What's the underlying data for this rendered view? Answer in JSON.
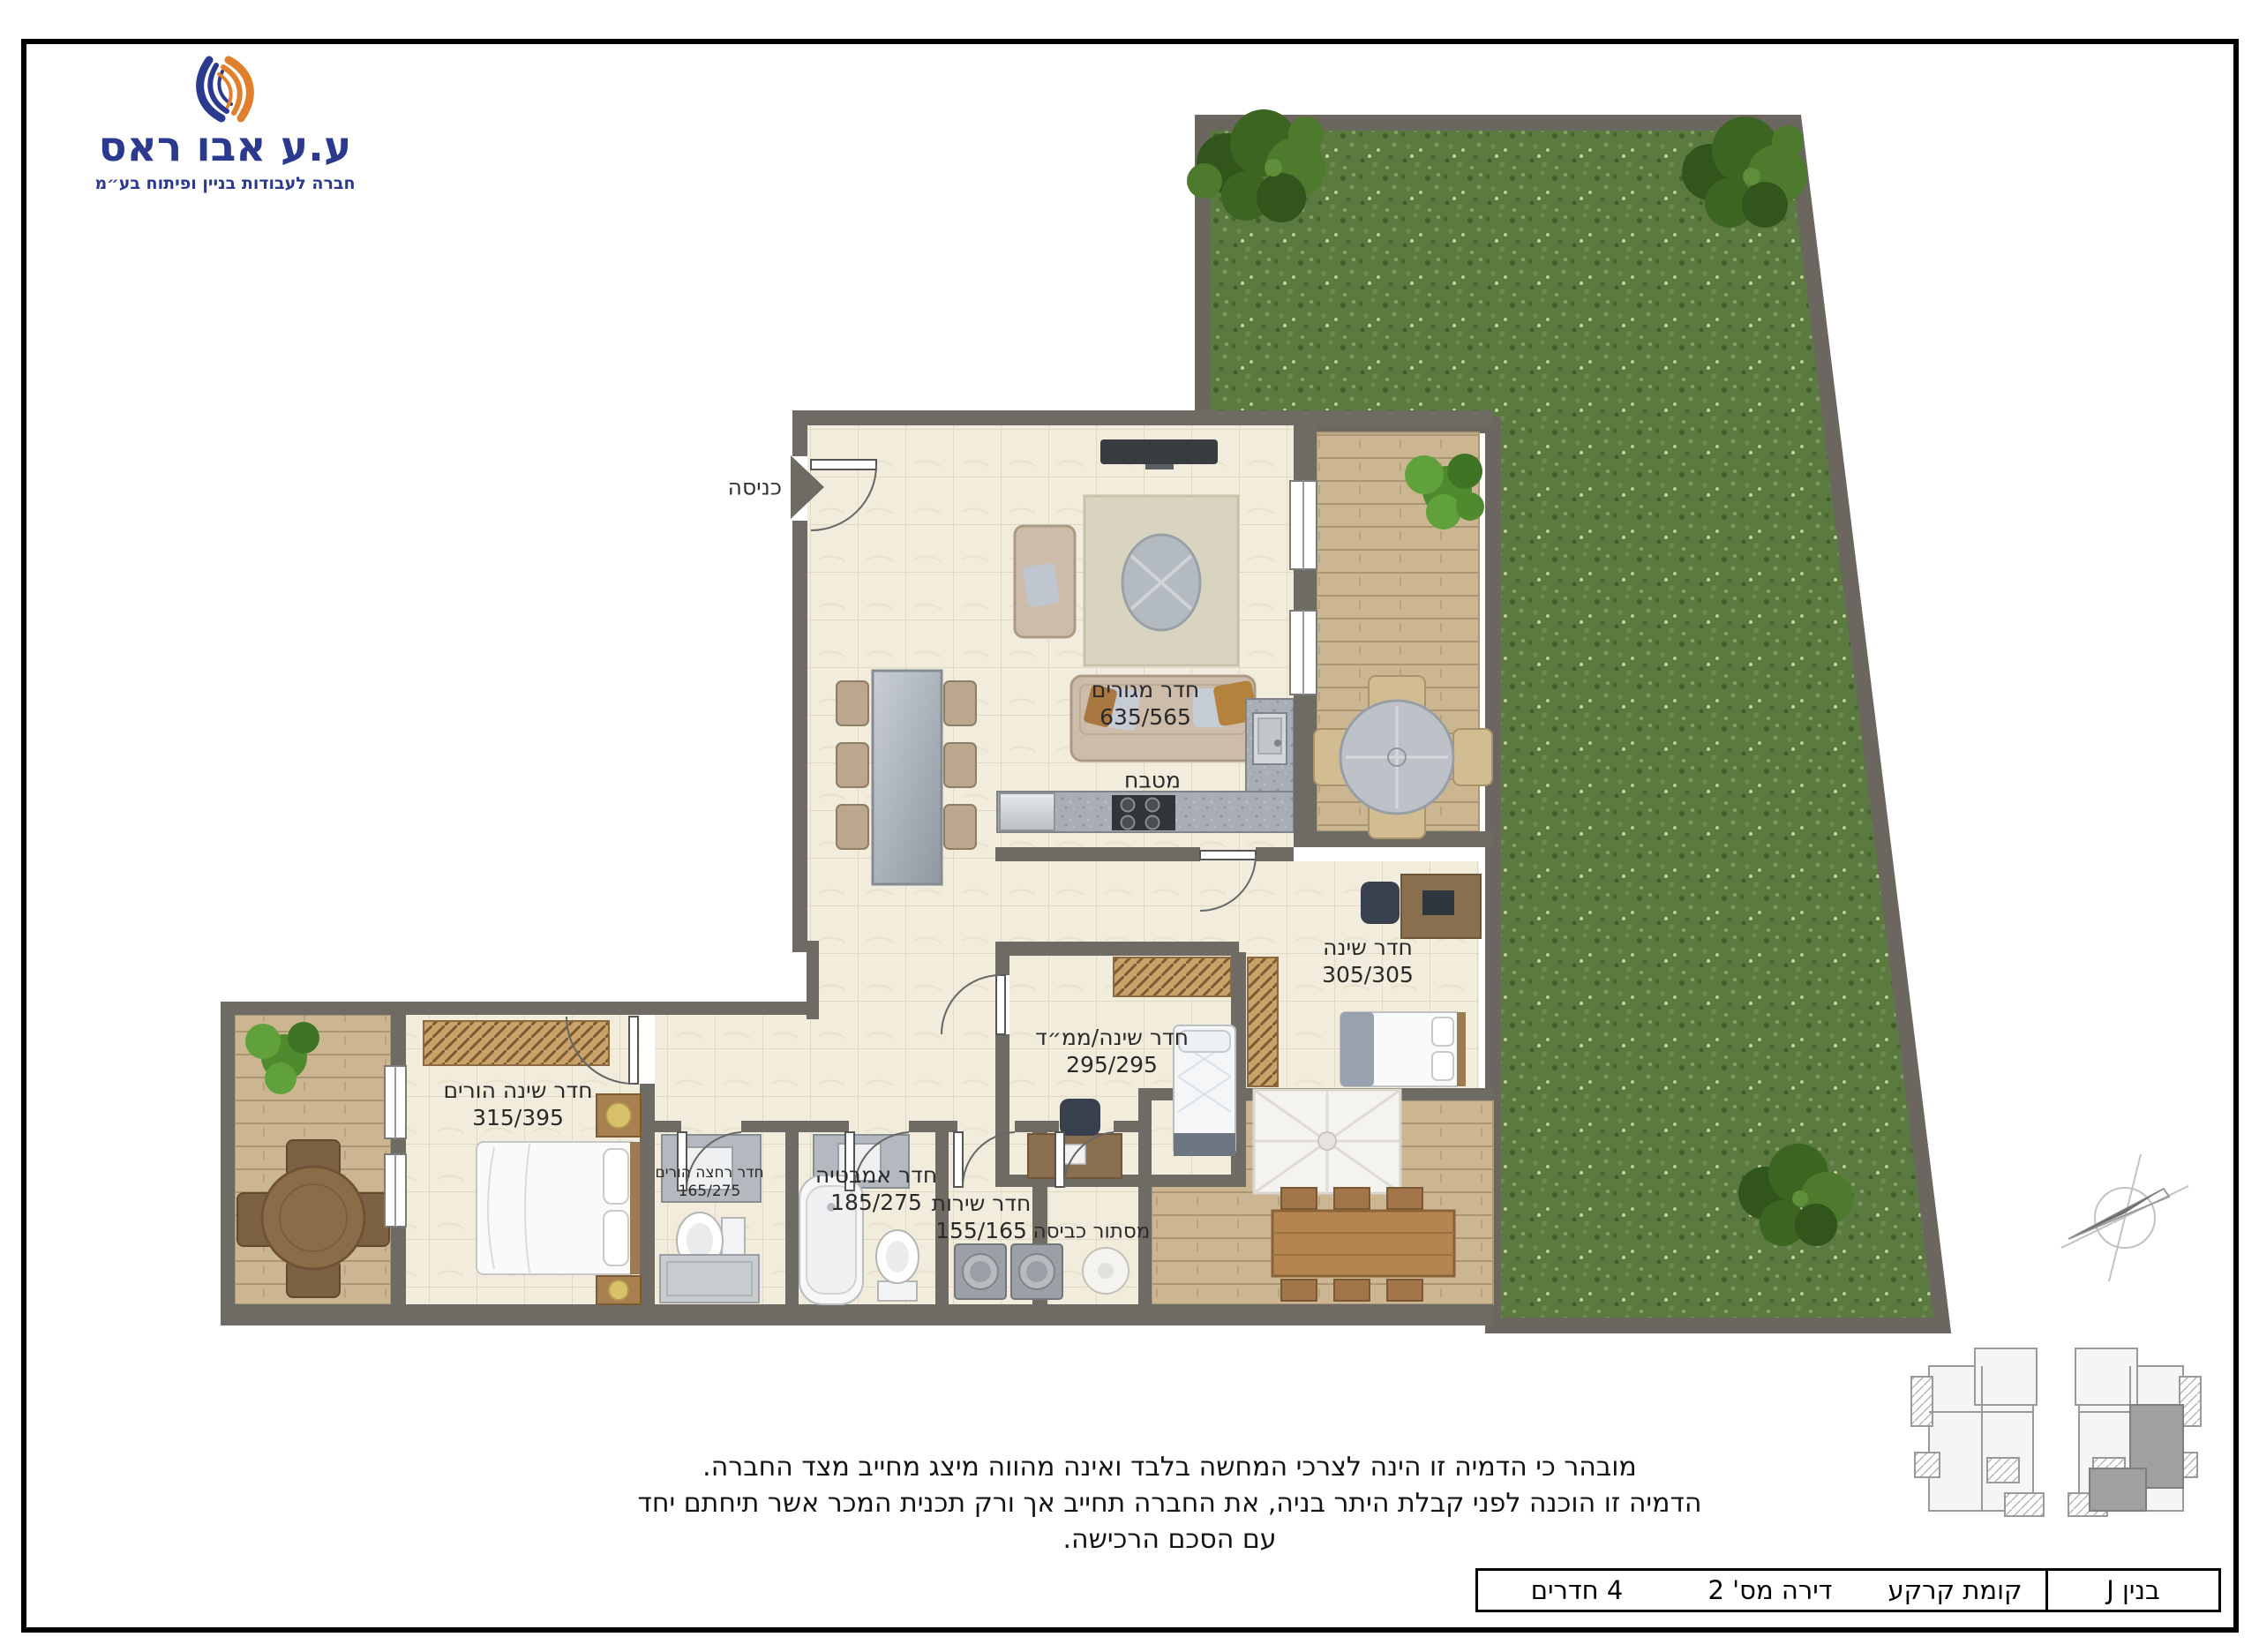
{
  "logo": {
    "company": "ע.ע אבו ראס",
    "tagline": "חברה לעבודות בניין ופיתוח בע״מ",
    "blue": "#2b3a8f",
    "orange": "#e0802f"
  },
  "plan": {
    "entrance_label": "כניסה",
    "rooms": {
      "living": {
        "name": "חדר מגורים",
        "dims": "635/565"
      },
      "kitchen": {
        "name": "מטבח"
      },
      "bedroom": {
        "name": "חדר שינה",
        "dims": "305/305"
      },
      "mamad": {
        "name": "חדר שינה/ממ״ד",
        "dims": "295/295"
      },
      "parents": {
        "name": "חדר שינה הורים",
        "dims": "315/395"
      },
      "parents_bath": {
        "name": "חדר רחצה הורים",
        "dims": "165/275"
      },
      "bathroom": {
        "name": "חדר אמבטיה",
        "dims": "185/275"
      },
      "service": {
        "name": "חדר שירות",
        "dims": "155/165"
      },
      "laundry": {
        "name": "מסתור כביסה"
      }
    },
    "colors": {
      "wall": "#6e6a64",
      "floor": "#f1ecdc",
      "deck": "#ccb691",
      "grass": "#5b7a40"
    }
  },
  "disclaimer": {
    "line1": "מובהר כי הדמיה זו הינה לצרכי המחשה בלבד ואינה מהווה מיצג מחייב מצד החברה.",
    "line2": "הדמיה זו הוכנה לפני קבלת היתר בניה, את החברה תחייב אך ורק תכנית המכר אשר תיחתם יחד עם הסכם הרכישה."
  },
  "summary_table": {
    "building": "בנין J",
    "floor": "קומת קרקע",
    "apartment": "דירה מס' 2",
    "rooms_count": "4 חדרים"
  }
}
